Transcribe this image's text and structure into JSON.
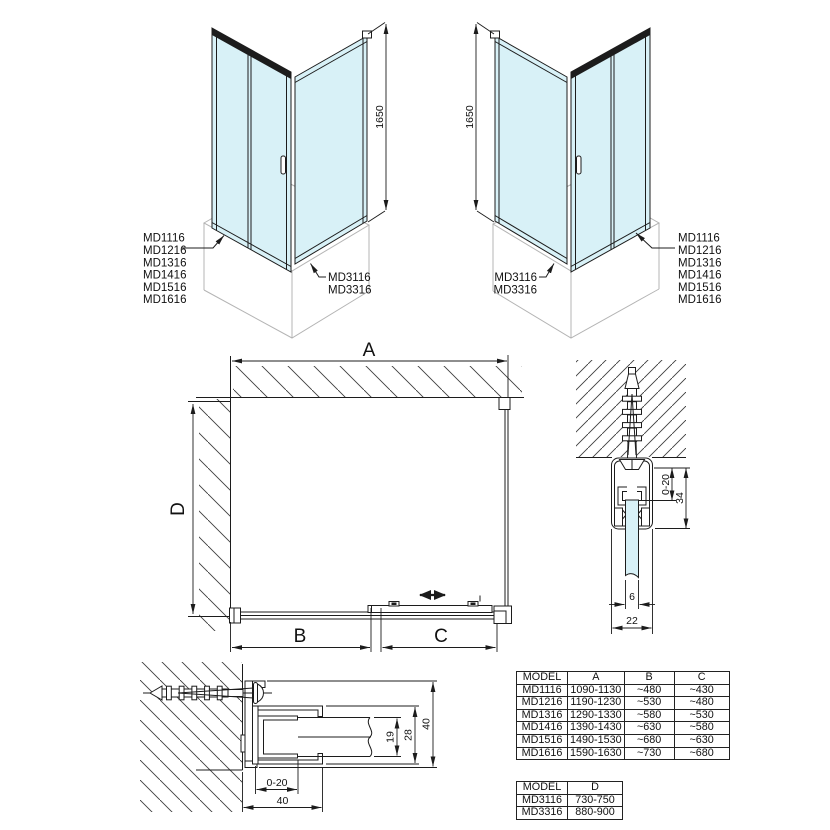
{
  "colors": {
    "line": "#1c1c1c",
    "glass": "#d8f1f7",
    "tray": "#b4b4b4"
  },
  "iso_left": {
    "height_dim": "1650",
    "door_models": [
      "MD1116",
      "MD1216",
      "MD1316",
      "MD1416",
      "MD1516",
      "MD1616"
    ],
    "side_models": [
      "MD3116",
      "MD3316"
    ]
  },
  "iso_right": {
    "height_dim": "1650",
    "door_models": [
      "MD1116",
      "MD1216",
      "MD1316",
      "MD1416",
      "MD1516",
      "MD1616"
    ],
    "side_models": [
      "MD3116",
      "MD3316"
    ]
  },
  "plan": {
    "width_dim": "A",
    "depth_dim": "D",
    "fixed_dim": "B",
    "door_dim": "C"
  },
  "top_rail_detail": {
    "adjust_dim": "0-20",
    "height_dim": "34",
    "glass_dim": "6",
    "width_dim": "22"
  },
  "wall_profile_detail": {
    "glass_dim": "19",
    "channel_dim": "28",
    "height_dim": "40",
    "adjust_dim": "0-20",
    "width_dim": "40"
  },
  "table_main": {
    "headers": [
      "MODEL",
      "A",
      "B",
      "C"
    ],
    "rows": [
      [
        "MD1116",
        "1090-1130",
        "~480",
        "~430"
      ],
      [
        "MD1216",
        "1190-1230",
        "~530",
        "~480"
      ],
      [
        "MD1316",
        "1290-1330",
        "~580",
        "~530"
      ],
      [
        "MD1416",
        "1390-1430",
        "~630",
        "~580"
      ],
      [
        "MD1516",
        "1490-1530",
        "~680",
        "~630"
      ],
      [
        "MD1616",
        "1590-1630",
        "~730",
        "~680"
      ]
    ]
  },
  "table_side": {
    "headers": [
      "MODEL",
      "D"
    ],
    "rows": [
      [
        "MD3116",
        "730-750"
      ],
      [
        "MD3316",
        "880-900"
      ]
    ]
  }
}
